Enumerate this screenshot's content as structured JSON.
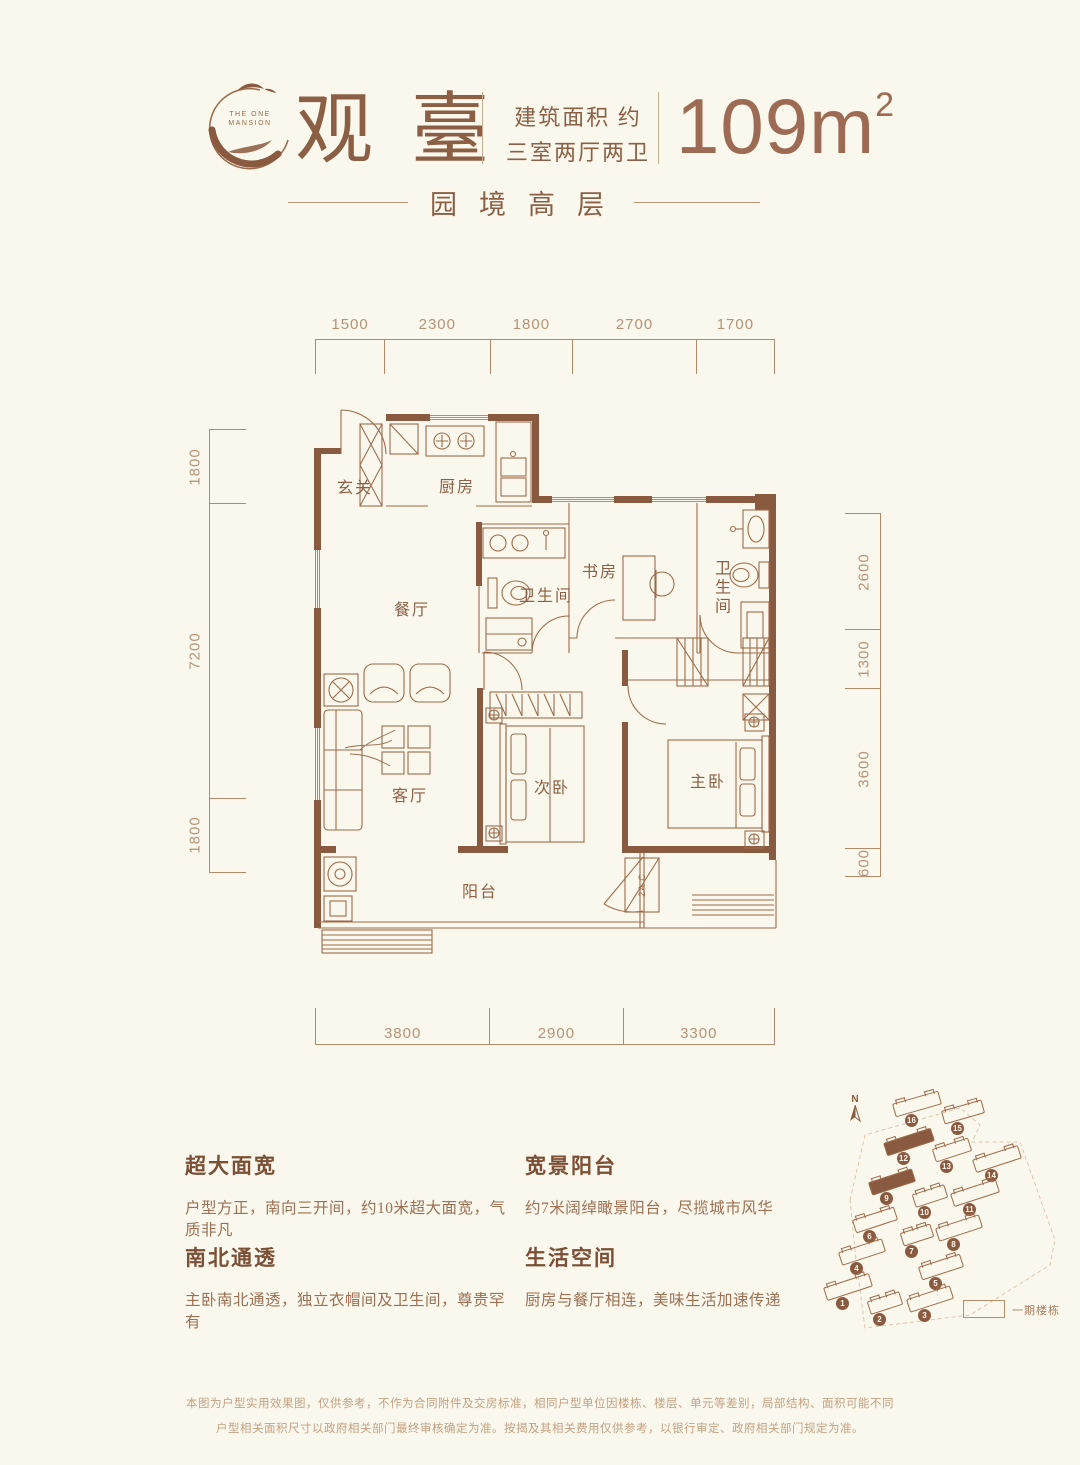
{
  "header": {
    "logo_line1": "THE ONE",
    "logo_line2": "MANSION",
    "title": "观臺",
    "spec_line1": "建筑面积 约",
    "spec_line2": "三室两厅两卫",
    "area_value": "109",
    "area_unit": "m",
    "area_sup": "2",
    "subtitle": "园境高层"
  },
  "plan": {
    "dims_top": [
      "1500",
      "2300",
      "1800",
      "2700",
      "1700"
    ],
    "dims_bottom": [
      "3800",
      "2900",
      "3300"
    ],
    "dims_left": [
      "1800",
      "7200",
      "1800"
    ],
    "dims_right": [
      "2600",
      "1300",
      "3600",
      "600"
    ],
    "rooms": {
      "foyer": "玄关",
      "kitchen": "厨房",
      "dining": "餐厅",
      "bath1": "卫生间",
      "study": "书房",
      "bath2": "卫生间",
      "living": "客厅",
      "bedroom2": "次卧",
      "master": "主卧",
      "balcony": "阳台",
      "ac_label": "2A C"
    }
  },
  "features": [
    {
      "title": "超大面宽",
      "desc": "户型方正，南向三开间，约10米超大面宽，气质非凡"
    },
    {
      "title": "南北通透",
      "desc": "主卧南北通透，独立衣帽间及卫生间，尊贵罕有"
    },
    {
      "title": "宽景阳台",
      "desc": "约7米阔绰瞰景阳台，尽揽城市风华"
    },
    {
      "title": "生活空间",
      "desc": "厨房与餐厅相连，美味生活加速传递"
    }
  ],
  "siteplan": {
    "north_label": "N",
    "legend_label": "一期楼栋",
    "buildings": [
      {
        "num": "16",
        "x": 916,
        "y": 1104,
        "w": 46,
        "rot": -16,
        "filled": false
      },
      {
        "num": "15",
        "x": 962,
        "y": 1112,
        "w": 40,
        "rot": -16,
        "filled": false
      },
      {
        "num": "12",
        "x": 908,
        "y": 1142,
        "w": 48,
        "rot": -18,
        "filled": true
      },
      {
        "num": "13",
        "x": 951,
        "y": 1150,
        "w": 36,
        "rot": -18,
        "filled": false
      },
      {
        "num": "14",
        "x": 996,
        "y": 1159,
        "w": 46,
        "rot": -18,
        "filled": false
      },
      {
        "num": "9",
        "x": 891,
        "y": 1182,
        "w": 44,
        "rot": -18,
        "filled": true
      },
      {
        "num": "10",
        "x": 929,
        "y": 1196,
        "w": 32,
        "rot": -18,
        "filled": false
      },
      {
        "num": "11",
        "x": 974,
        "y": 1193,
        "w": 46,
        "rot": -18,
        "filled": false
      },
      {
        "num": "6",
        "x": 874,
        "y": 1220,
        "w": 42,
        "rot": -18,
        "filled": false
      },
      {
        "num": "8",
        "x": 958,
        "y": 1228,
        "w": 44,
        "rot": -18,
        "filled": false
      },
      {
        "num": "7",
        "x": 916,
        "y": 1235,
        "w": 30,
        "rot": -18,
        "filled": false
      },
      {
        "num": "4",
        "x": 861,
        "y": 1252,
        "w": 44,
        "rot": -18,
        "filled": false
      },
      {
        "num": "5",
        "x": 940,
        "y": 1267,
        "w": 42,
        "rot": -18,
        "filled": false
      },
      {
        "num": "1",
        "x": 847,
        "y": 1287,
        "w": 46,
        "rot": -18,
        "filled": false
      },
      {
        "num": "2",
        "x": 884,
        "y": 1303,
        "w": 32,
        "rot": -18,
        "filled": false
      },
      {
        "num": "3",
        "x": 929,
        "y": 1299,
        "w": 44,
        "rot": -18,
        "filled": false
      }
    ]
  },
  "disclaimer": [
    "本图为户型实用效果图，仅供参考，不作为合同附件及交房标准，相同户型单位因楼栋、楼层、单元等差别，局部结构、面积可能不同",
    "户型相关面积尺寸以政府相关部门最终审核确定为准。按揭及其相关费用仅供参考，以银行审定、政府相关部门规定为准。"
  ],
  "colors": {
    "background": "#faf7ec",
    "wall": "#8a5a40",
    "line": "#9c6b4b",
    "text": "#8a5f45",
    "dim": "#b5937a",
    "area_number": "#9d6a53"
  }
}
